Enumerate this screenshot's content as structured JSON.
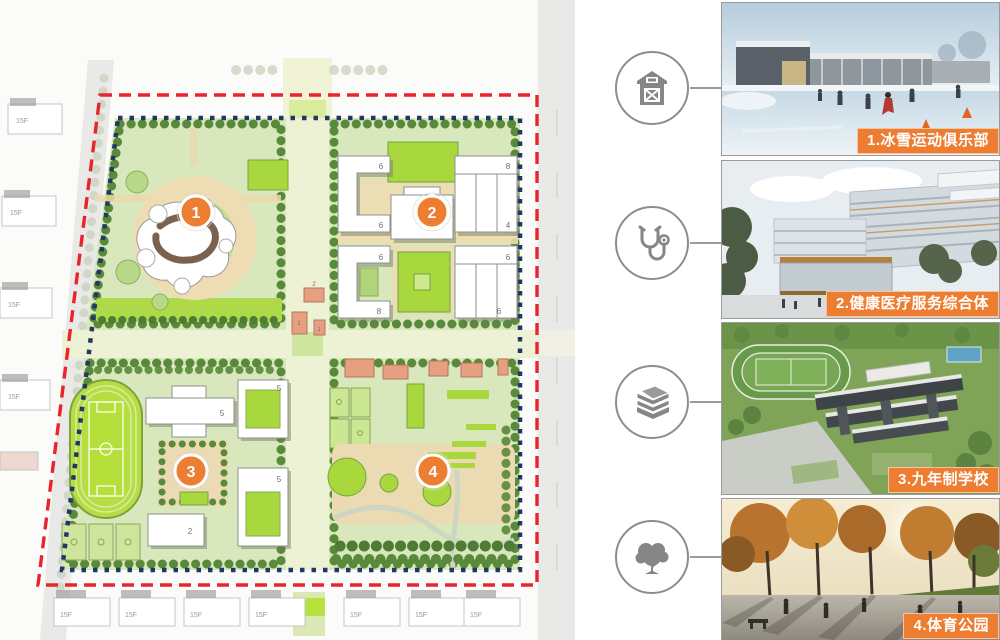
{
  "plan": {
    "markers": [
      "1",
      "2",
      "3",
      "4"
    ],
    "marker_color": "#ed7d31",
    "boundary_red": "#e8252a",
    "boundary_blue": "#1f3864",
    "context_floor_label": "15F",
    "q2_floor_labels": [
      "6",
      "6",
      "8",
      "4",
      "6",
      "8",
      "6",
      "6"
    ],
    "q3_floor_labels": [
      "5",
      "5",
      "5",
      "2"
    ],
    "center_building_labels": [
      "2",
      "1",
      "1"
    ]
  },
  "legend": {
    "accent_color": "#ed7d31",
    "items": [
      {
        "icon": "barn-icon",
        "label": "1.冰雪运动俱乐部"
      },
      {
        "icon": "stethoscope-icon",
        "label": "2.健康医疗服务综合体"
      },
      {
        "icon": "books-icon",
        "label": "3.九年制学校"
      },
      {
        "icon": "tree-icon",
        "label": "4.体育公园"
      }
    ]
  }
}
